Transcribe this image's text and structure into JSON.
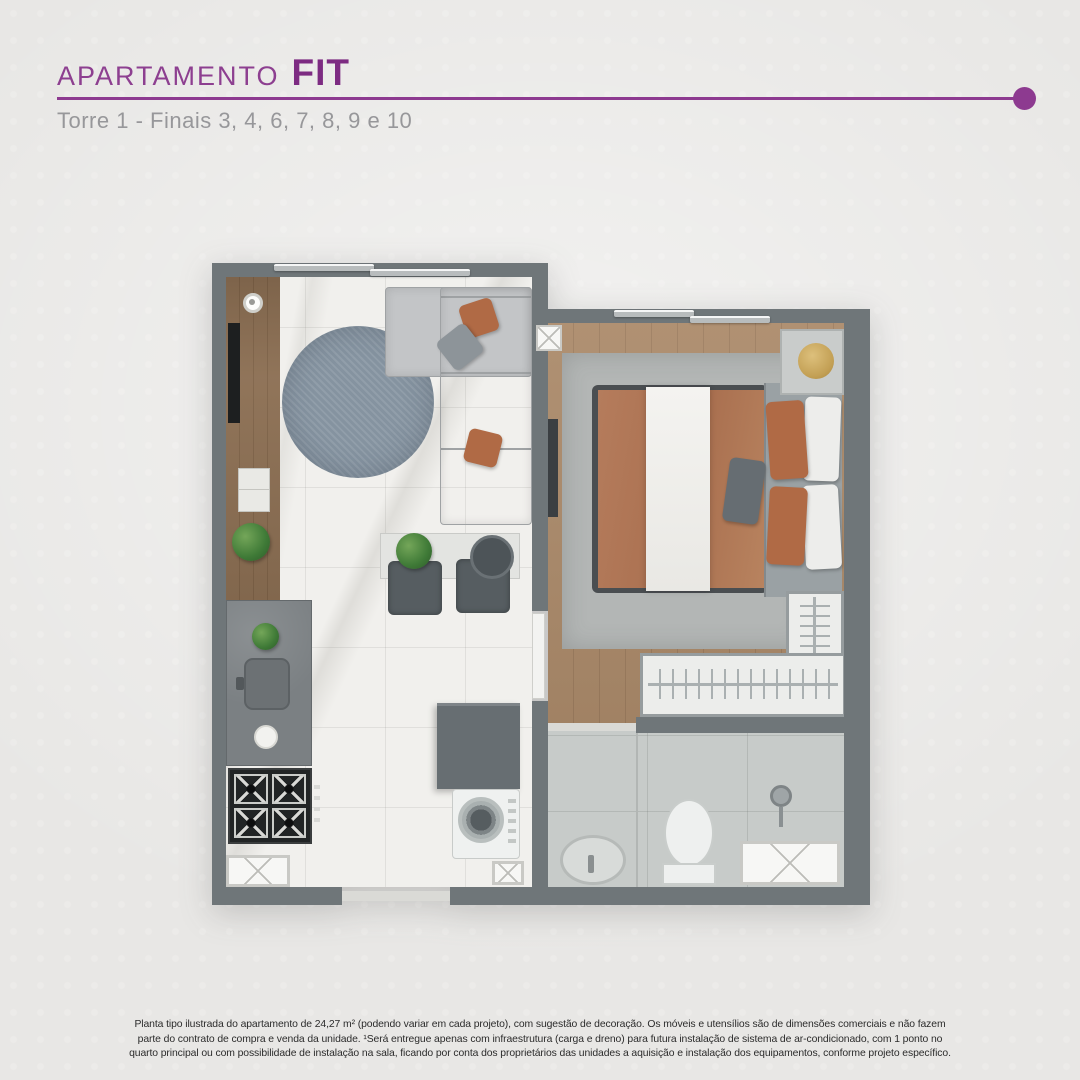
{
  "page": {
    "background_color": "#e8e7e5",
    "accent_color": "#8d3a90"
  },
  "header": {
    "title_prefix": "APARTAMENTO",
    "title_emphasis": "FIT",
    "subtitle": "Torre 1 - Finais 3, 4, 6, 7, 8, 9 e 10"
  },
  "floor_plan": {
    "type": "apartment-top-view-floor-plan",
    "colors": {
      "wall": "#6f7679",
      "marble_floor": "#f1f0ed",
      "wood_floor": "#ab8a6a",
      "bathroom_tile": "#c7cbc9",
      "living_rug": "#8593a0",
      "bedroom_rug": "#b3b6b5",
      "sofa": "#c3c5c7",
      "terracotta_accent": "#b06a45",
      "bed_duvet": "#b37a5a",
      "brass": "#c8a65c"
    },
    "elements": [
      "living-window",
      "bedroom-window",
      "tv-rack",
      "round-rug",
      "l-shaped-sofa",
      "dining-chairs",
      "side-table",
      "kitchen-counter",
      "sink",
      "cooktop",
      "refrigerator",
      "washing-machine",
      "entry-threshold",
      "double-bed",
      "nightstand",
      "wardrobe",
      "bathroom-sink",
      "toilet",
      "shower",
      "shaft-boxes"
    ]
  },
  "disclaimer": {
    "line1": "Planta tipo ilustrada do apartamento de 24,27 m² (podendo variar em cada projeto), com sugestão de decoração. Os móveis e utensílios são de dimensões comerciais e não fazem",
    "line2": "parte do contrato de compra e venda da unidade. ¹Será entregue apenas com infraestrutura (carga e dreno) para futura instalação de sistema de ar-condicionado, com 1 ponto no",
    "line3": "quarto principal ou com possibilidade de instalação na sala, ficando por conta dos proprietários das unidades a aquisição e instalação dos equipamentos, conforme projeto específico."
  }
}
